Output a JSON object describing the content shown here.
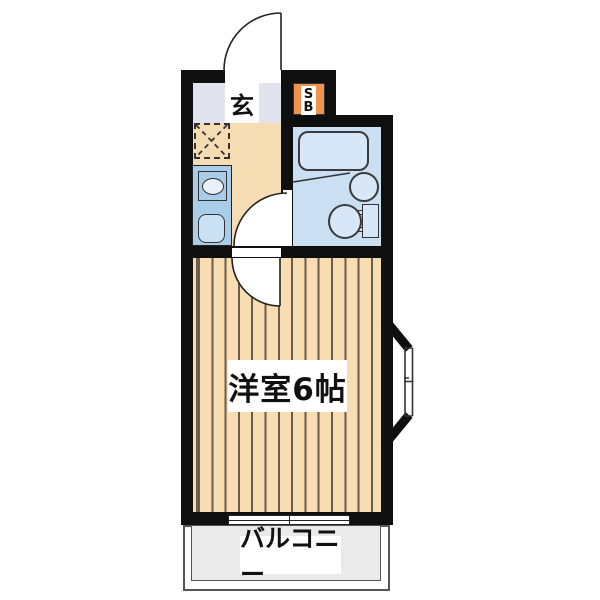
{
  "floor_plan": {
    "type": "apartment-floor-plan",
    "labels": {
      "entrance": "玄",
      "shoe_box_line1": "S",
      "shoe_box_line2": "B",
      "main_room": "洋室6帖",
      "balcony": "バルコニー"
    },
    "rooms": [
      {
        "name": "entrance",
        "label": "玄"
      },
      {
        "name": "kitchen",
        "label": ""
      },
      {
        "name": "bathroom",
        "label": ""
      },
      {
        "name": "western-room",
        "label": "洋室6帖",
        "size_mats": 6
      },
      {
        "name": "balcony",
        "label": "バルコニー"
      }
    ],
    "colors": {
      "wall": "#0f0f0f",
      "entrance_floor": "#e3e3ef",
      "kitchen_floor": "#f6dcb3",
      "bathroom_floor": "#cbdff3",
      "fixture_fill": "#d7e7f8",
      "kitchen_unit": "#a9cde9",
      "kitchen_sink": "#c9e1f3",
      "shoe_box": "#f0934e",
      "wood_floor": "#f8dcb2",
      "wood_stripe": "#6b5d4c",
      "balcony_fill": "#eaeaea"
    }
  }
}
